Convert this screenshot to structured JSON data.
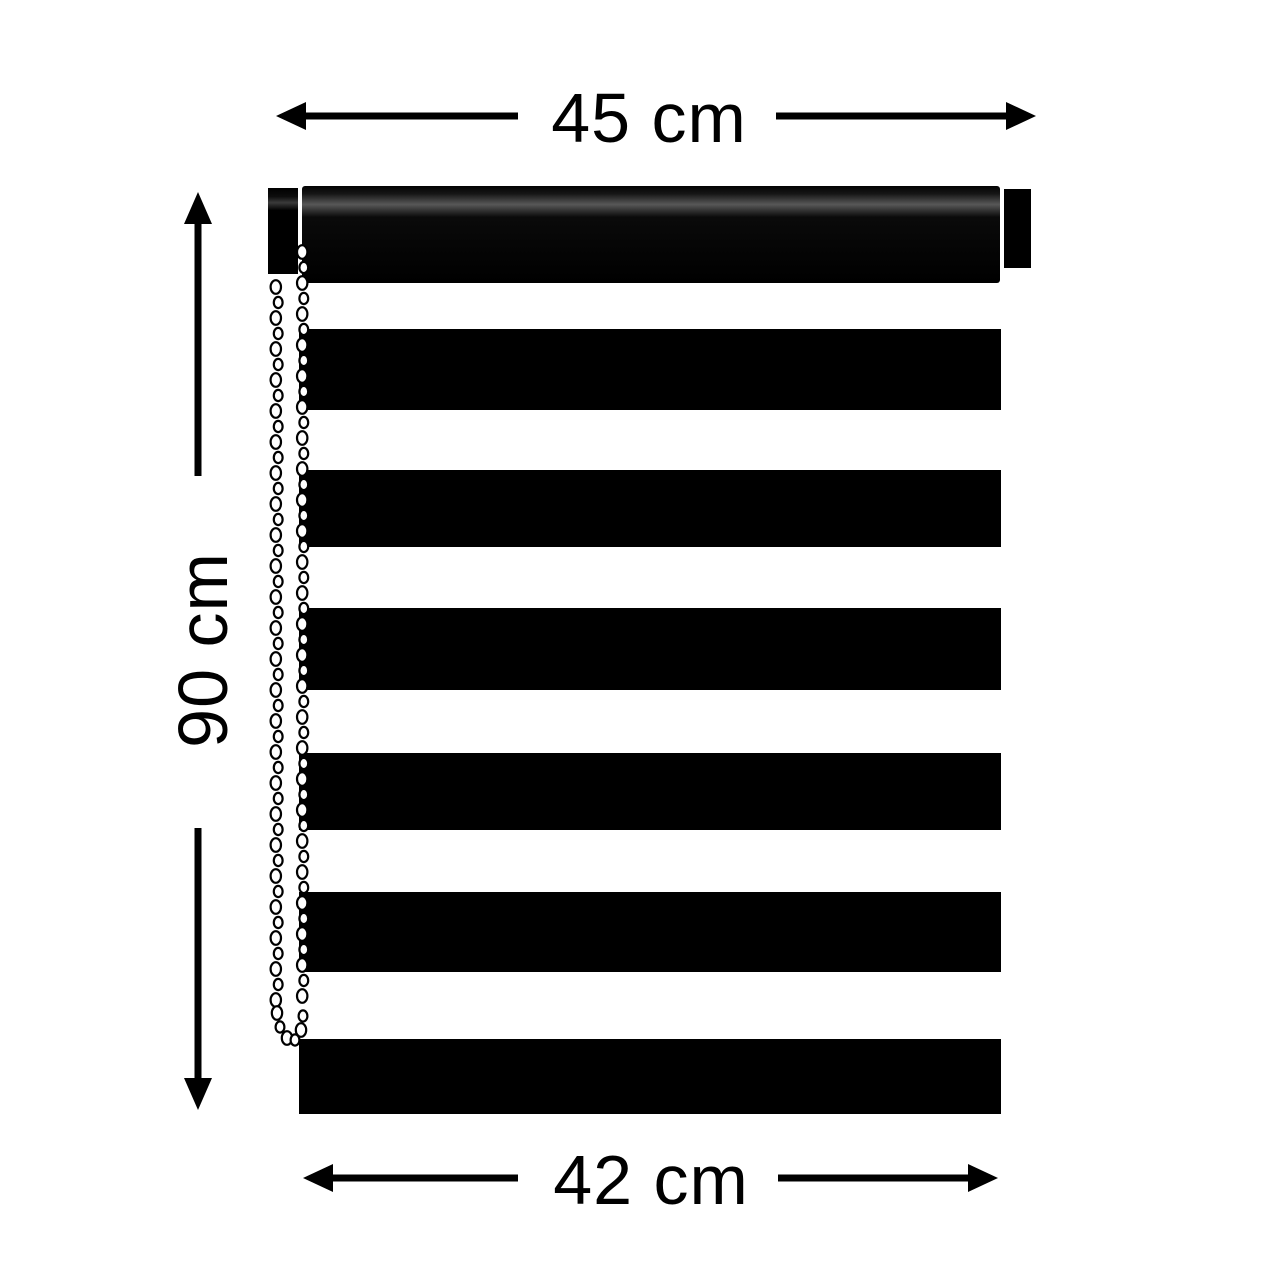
{
  "canvas": {
    "background": "#ffffff",
    "ink": "#000000",
    "roller_highlight": "#565656"
  },
  "dimensions": {
    "top_width": {
      "label": "45 cm",
      "value": 45,
      "unit": "cm"
    },
    "side_height": {
      "label": "90 cm",
      "value": 90,
      "unit": "cm"
    },
    "bottom_width": {
      "label": "42 cm",
      "value": 42,
      "unit": "cm"
    }
  }
}
